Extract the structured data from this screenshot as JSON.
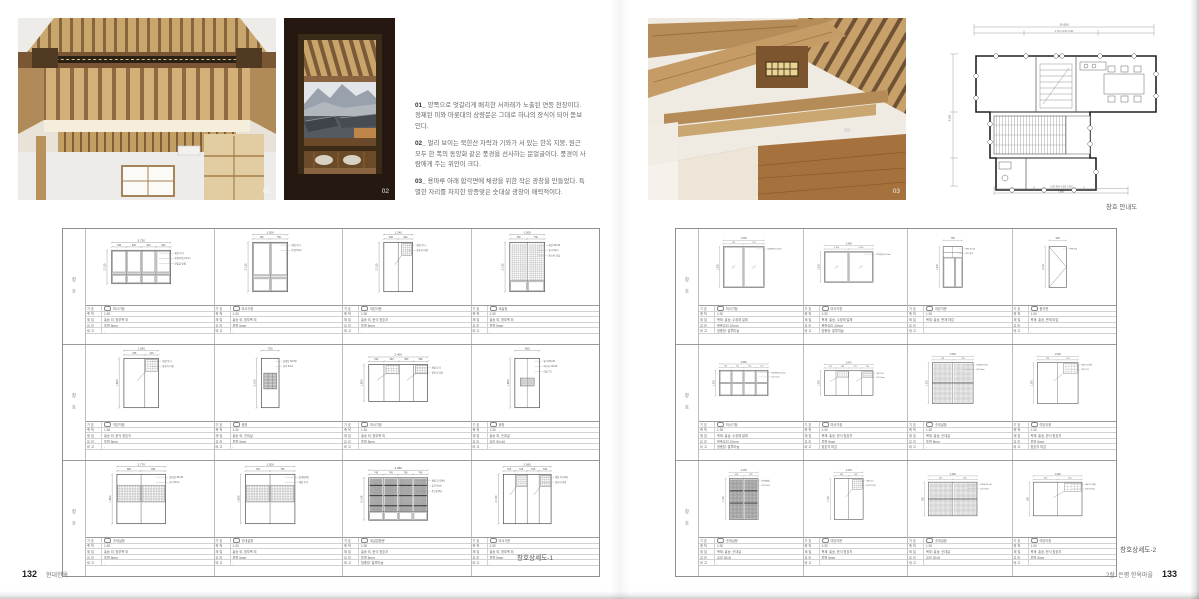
{
  "colors": {
    "wood_light": "#cfa96e",
    "wood_mid": "#b08a58",
    "wood_dark": "#6b4a2e",
    "wall": "#edebe7",
    "sky": "#e3e6e8",
    "mountain": "#99a2ac",
    "floor": "#a5713d",
    "line": "#555555"
  },
  "page_left": {
    "number": "132",
    "footer": "현대한옥",
    "photo1_label": "01",
    "photo2_label": "02",
    "sheet_title": "창호상세도-1",
    "grid_label": "창 호",
    "captions": [
      {
        "num": "01_",
        "text": "양쪽으로 엇갈리게 배치한 서까래가 노출된 연등 천장이다. 정제된 미와 마룻대의 상량문은 그대로 하나의 장식이 되어 돋보인다."
      },
      {
        "num": "02_",
        "text": "멀리 보이는 북한산 자락과 기와가 서 있는 한옥 지붕, 원근 모두 한 폭의 동양화 같은 풍경을 선사하는 문얼굴이다. 풍경이 사람에게 주는 위안이 크다."
      },
      {
        "num": "03_",
        "text": "용마루 아래 합각면에 채광을 위한 작은 광창을 만들었다. 특별한 자리를 차지한 앙증맞은 숫대살 광창이 매력적이다."
      }
    ]
  },
  "page_right": {
    "number": "133",
    "footer": "2장. 은평 한옥마을",
    "photo3_label": "03",
    "plan_caption": "창호 안내도",
    "sheet_title": "창호상세도-2",
    "grid_label": "창 호"
  },
  "plan": {
    "dim_top_total": "10,600",
    "dim_top_segs": "2,740      4,430      3,430",
    "dim_left_total": "9,180",
    "dim_bottom_total": "7,880",
    "dim_bottom_segs": "1,300   900   4,280   1,400"
  },
  "detail_table_labels": [
    "기 호",
    "축 척",
    "재 질",
    "유 리",
    "비 고"
  ],
  "grid1_cells": [
    {
      "t": "p4top",
      "w": "3,750",
      "segs": [
        "940",
        "940",
        "940",
        "940"
      ],
      "h": "2,130",
      "name": "미서기창",
      "scale": "1:30",
      "mat": "홍송 외, 방부목 외",
      "glass": "투명 5mm",
      "note": "-",
      "ann": [
        "세살 무늬",
        "투명(복층) 5mm",
        "문얼굴 받침"
      ]
    },
    {
      "t": "p2top",
      "w": "1,500",
      "segs": [
        "750",
        "750"
      ],
      "h": "2,130",
      "name": "미서기창",
      "scale": "1:30",
      "mat": "홍송 외, 방부목 외",
      "glass": "투명 5mm",
      "note": "-",
      "ann": [
        "세살 무늬",
        "투명 5mm"
      ]
    },
    {
      "t": "corner1",
      "w": "1,240",
      "segs": [
        "620",
        "620"
      ],
      "h": "2,130",
      "name": "여닫이문",
      "scale": "1:30",
      "mat": "홍송 외, 한식 창호지",
      "glass": "투명 5mm",
      "note": "-",
      "ann": [
        "세살 무늬",
        "창호지 마감"
      ]
    },
    {
      "t": "latt2b",
      "w": "1,500",
      "segs": [
        "750",
        "750"
      ],
      "h": "2,130",
      "name": "세살창",
      "scale": "1:30",
      "mat": "홍송 외, 방부목 외",
      "glass": "투명 5mm",
      "note": "-",
      "ann": [
        "세살 30×40",
        "유리 5mm",
        "풍소란 간살"
      ]
    },
    {
      "t": "corner1",
      "w": "1,050",
      "segs": [
        "635",
        "415"
      ],
      "h": "1,500",
      "name": "여닫이창",
      "scale": "1:30",
      "mat": "홍송 외, 한식 창호지",
      "glass": "투명 5mm",
      "note": "-",
      "ann": [
        "세살 무늬",
        "창호지 마감"
      ]
    },
    {
      "t": "hatchC",
      "w": "750",
      "segs": [],
      "h": "2,100",
      "name": "광창",
      "scale": "1:30",
      "mat": "홍송 외, 숫대살",
      "glass": "투명 5mm",
      "note": "-",
      "ann": [
        "숫대살 30×30",
        "유리 5mm"
      ]
    },
    {
      "t": "corner2",
      "w": "2,400",
      "segs": [
        "620",
        "620",
        "580",
        "580"
      ],
      "h": "1,500",
      "name": "미서기창",
      "scale": "1:30",
      "mat": "홍송 외, 방부목 외",
      "glass": "투명 5mm",
      "note": "-",
      "ann": [
        "세살 무늬",
        "창호지 마감"
      ]
    },
    {
      "t": "hatchM",
      "w": "900",
      "segs": [],
      "h": "1,800",
      "name": "광창",
      "scale": "1:30",
      "mat": "홍송 외, 숫대살",
      "glass": "유리 50×40",
      "note": "-",
      "ann": [
        "유리 50×40",
        "쇠시리 10×20",
        "간살 7.5"
      ]
    },
    {
      "t": "latt2mid",
      "w": "1,770",
      "segs": [
        "880",
        "890"
      ],
      "h": "1,800",
      "name": "숫대살창",
      "scale": "1:30",
      "mat": "홍송 외, 방부목 외",
      "glass": "투명 5mm",
      "note": "-",
      "ann": [
        "숫대살 30×30",
        "유리 5mm"
      ]
    },
    {
      "t": "latt2mid",
      "w": "1,500",
      "segs": [
        "745",
        "755"
      ],
      "h": "1,500",
      "name": "숫대살창",
      "scale": "1:30",
      "mat": "홍송 외, 방부목 외",
      "glass": "투명 5mm",
      "note": "-",
      "ann": [
        "숫대살(특)",
        "세살 무늬"
      ]
    },
    {
      "t": "dark4",
      "w": "2,980",
      "segs": [
        "745",
        "745",
        "745",
        "745"
      ],
      "h": "2,145",
      "name": "세살분합문",
      "scale": "1:30",
      "mat": "홍송 외, 한식 창호지",
      "glass": "투명 5mm",
      "note": "방충망: 알루미늄",
      "ann": [
        "세살 무늬(특)",
        "유리 5mm",
        "풍소란(특)"
      ]
    },
    {
      "t": "corner2",
      "w": "2,060",
      "segs": [
        "515",
        "515",
        "515",
        "515"
      ],
      "h": "2,130",
      "name": "미서기문",
      "scale": "1:30",
      "mat": "홍송 외, 방부목 외",
      "glass": "투명 5mm",
      "note": "-",
      "ann": [
        "세살 무늬(특)",
        "창호지 마감"
      ]
    }
  ],
  "grid2_cells": [
    {
      "t": "slide2",
      "w": "1,500",
      "segs": [
        "750",
        "750"
      ],
      "h": "1,500",
      "name": "미서기창",
      "scale": "1:30",
      "mat": "목재: 홍송, 수장재 일체",
      "glass": "복층유리 22mm",
      "note": "방충망: 알루미늄",
      "ann": [
        "투명(복층) 22mm"
      ]
    },
    {
      "t": "slide2",
      "w": "2,400",
      "segs": [
        "1,200",
        "1,200"
      ],
      "h": "1,500",
      "name": "미서기창",
      "scale": "1:30",
      "mat": "목재: 홍송, 수장재 일체",
      "glass": "복층유리 22mm",
      "note": "방충망: 알루미늄",
      "ann": [
        "투명(복층) 22mm"
      ]
    },
    {
      "t": "doortop",
      "w": "750",
      "segs": [],
      "h": "1,600",
      "name": "여닫이문",
      "scale": "1:30",
      "mat": "목재: 홍송, 판재 마감",
      "glass": "-",
      "note": "-",
      "ann": [
        "중판 30×40",
        "문선 살대"
      ]
    },
    {
      "t": "tri",
      "w": "900",
      "segs": [],
      "h": "2,130",
      "name": "합각판",
      "scale": "1:30",
      "mat": "목재: 홍송, 판재 마감",
      "glass": "-",
      "note": "-",
      "ann": [
        "판재 마감"
      ]
    },
    {
      "t": "p4plain",
      "w": "2,860",
      "segs": [
        "715",
        "715",
        "715",
        "715"
      ],
      "h": "1,500",
      "name": "미서기창",
      "scale": "1:30",
      "mat": "목재: 홍송, 수장재 일체",
      "glass": "복층유리 22mm",
      "note": "방충망: 알루미늄",
      "ann": [
        "투명(복층) 22mm",
        "유리 5mm"
      ]
    },
    {
      "t": "corner2",
      "w": "2,975",
      "segs": [
        "710",
        "780",
        "775",
        "710"
      ],
      "h": "1,500",
      "name": "미서기창",
      "scale": "1:30",
      "mat": "목재: 홍송, 한식 창호지",
      "glass": "투명 5mm",
      "note": "창호지 마감",
      "ann": [
        "광창 무늬",
        "유리 5mm"
      ]
    },
    {
      "t": "latt2",
      "w": "1,500",
      "segs": [
        "750",
        "750"
      ],
      "h": "1,500",
      "name": "숫대살창",
      "scale": "1:30",
      "mat": "목재: 홍송, 숫대살",
      "glass": "투명 5mm",
      "note": "-",
      "ann": [
        "숫대살 30×40",
        "유리 5mm"
      ]
    },
    {
      "t": "corner1",
      "w": "1,500",
      "segs": [
        "750",
        "750"
      ],
      "h": "1,500",
      "name": "여닫이창",
      "scale": "1:30",
      "mat": "목재: 홍송, 한식 창호지",
      "glass": "투명 5mm",
      "note": "창호지 마감",
      "ann": [
        "세살 무늬(특)",
        "광창 무늬"
      ]
    },
    {
      "t": "dark2",
      "w": "1,245",
      "segs": [
        "620",
        "625"
      ],
      "h": "1,760",
      "name": "숫대살문",
      "scale": "1:30",
      "mat": "목재: 홍송, 숫대살",
      "glass": "유리 30×8",
      "note": "-",
      "ann": [
        "숫대살(틀)",
        "유리 30×8"
      ]
    },
    {
      "t": "corner1",
      "w": "1,245",
      "segs": [
        "620",
        "625"
      ],
      "h": "1,760",
      "name": "여닫이문",
      "scale": "1:30",
      "mat": "목재: 홍송, 한식 창호지",
      "glass": "투명 5mm",
      "note": "-",
      "ann": [
        "세살 무늬",
        "창호지 마감"
      ]
    },
    {
      "t": "latt2",
      "w": "1,300",
      "segs": [
        "650",
        "650"
      ],
      "h": "900",
      "name": "숫대살창",
      "scale": "1:30",
      "mat": "목재: 홍송, 숫대살",
      "glass": "유리 30×8",
      "note": "-",
      "ann": [
        "숫대살 30×40",
        "유리 30×8"
      ]
    },
    {
      "t": "corner1",
      "w": "1,300",
      "segs": [
        "650",
        "650"
      ],
      "h": "900",
      "name": "여닫이창",
      "scale": "1:30",
      "mat": "목재: 홍송, 한식 창호지",
      "glass": "투명 5mm",
      "note": "-",
      "ann": [
        "세살 무늬(특)",
        "창호지 마감"
      ]
    }
  ]
}
